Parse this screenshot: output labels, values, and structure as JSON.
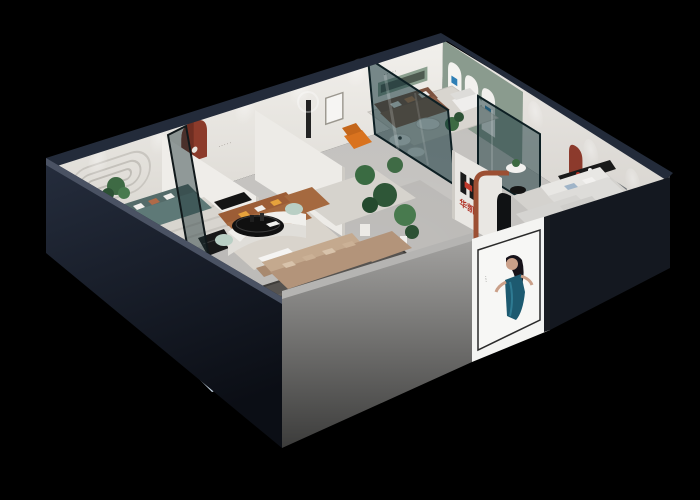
{
  "scene": {
    "type": "3d-isometric-showroom-render",
    "description": "Isometric cutaway 3D render of a furniture brand showroom with multiple furnished display rooms, glass partitions and a front entrance",
    "background": "#000000"
  },
  "brand": {
    "name": "华凯",
    "mark": "H",
    "red": "#c0392b",
    "dark": "#16181c"
  },
  "signage": {
    "logo_wall_text": "华凯",
    "reception_desk_text": "华凯",
    "wall_plaque_text": "·····",
    "green_wall_plaque_text": "·····",
    "poster_caption": "····",
    "display_strip_text": "··"
  },
  "poster": {
    "subject": "model in teal dress",
    "panel_color": "#f7f7f5",
    "dress_color": "#1d5a70"
  },
  "display_arches": {
    "count": 3,
    "badge_color": "#2f7fb5"
  },
  "palette": {
    "wall_top": "#232b3a",
    "wall_inner": "#edebe7",
    "wall_outer_dark": "#161b26",
    "wall_outer_gray": "#8f8f8d",
    "floor": "#c2c0bd",
    "accent_green_wall": "#8a9b8e",
    "glass": "#16363a",
    "mosaic_floor": "#a9c2d1",
    "rug_dark": "#565350",
    "rug_light": "#d8d5cf",
    "sofa_tan": "#b3947a",
    "sofa_caramel": "#a5693f",
    "sofa_brown": "#8a5d47",
    "sofa_teal": "#5e7977",
    "sofa_white": "#e8e7e4",
    "sofa_lightblue": "#c5d4e2",
    "accent_terracotta": "#9c4f33",
    "accent_red": "#a63326",
    "accent_orange": "#e6a23c",
    "plant_green": "#3a6b42"
  }
}
